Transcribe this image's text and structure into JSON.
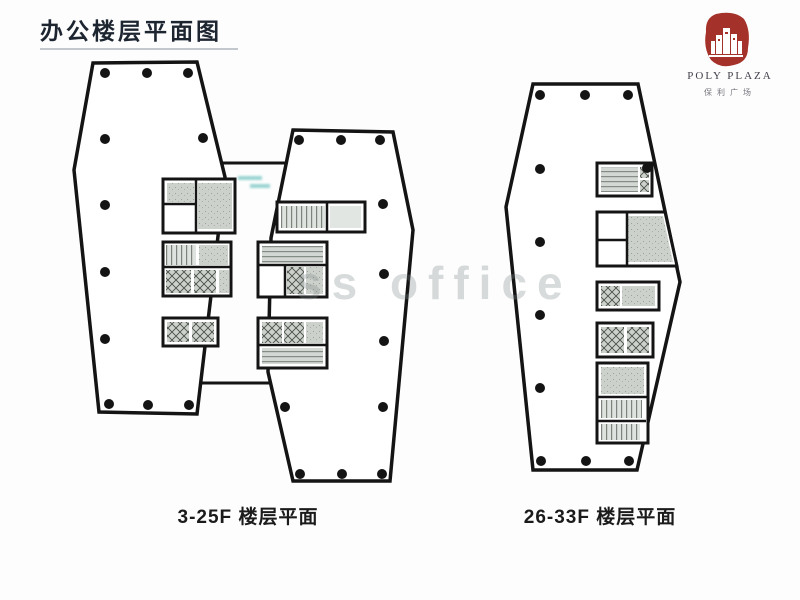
{
  "page": {
    "title": "办公楼层平面图"
  },
  "logo": {
    "en": "POLY PLAZA",
    "cn": "保利广场",
    "seal_color": "#a5322a"
  },
  "plans": [
    {
      "id": "tower-low-zone",
      "floors": "3-25F",
      "label": "3-25F 楼层平面"
    },
    {
      "id": "tower-high-zone",
      "floors": "26-33F",
      "label": "26-33F 楼层平面"
    }
  ],
  "watermark": {
    "text": "ss office"
  },
  "colors": {
    "title_text": "#1d2531",
    "label_text": "#1b1b1b",
    "wall_black": "#141414",
    "room_gray": "#ccd1cc",
    "room_light_gray": "#e2e6e2",
    "annotation_teal": "#4ab4ae",
    "logo_en_text": "#40404b",
    "logo_cn_text": "#76767f"
  }
}
